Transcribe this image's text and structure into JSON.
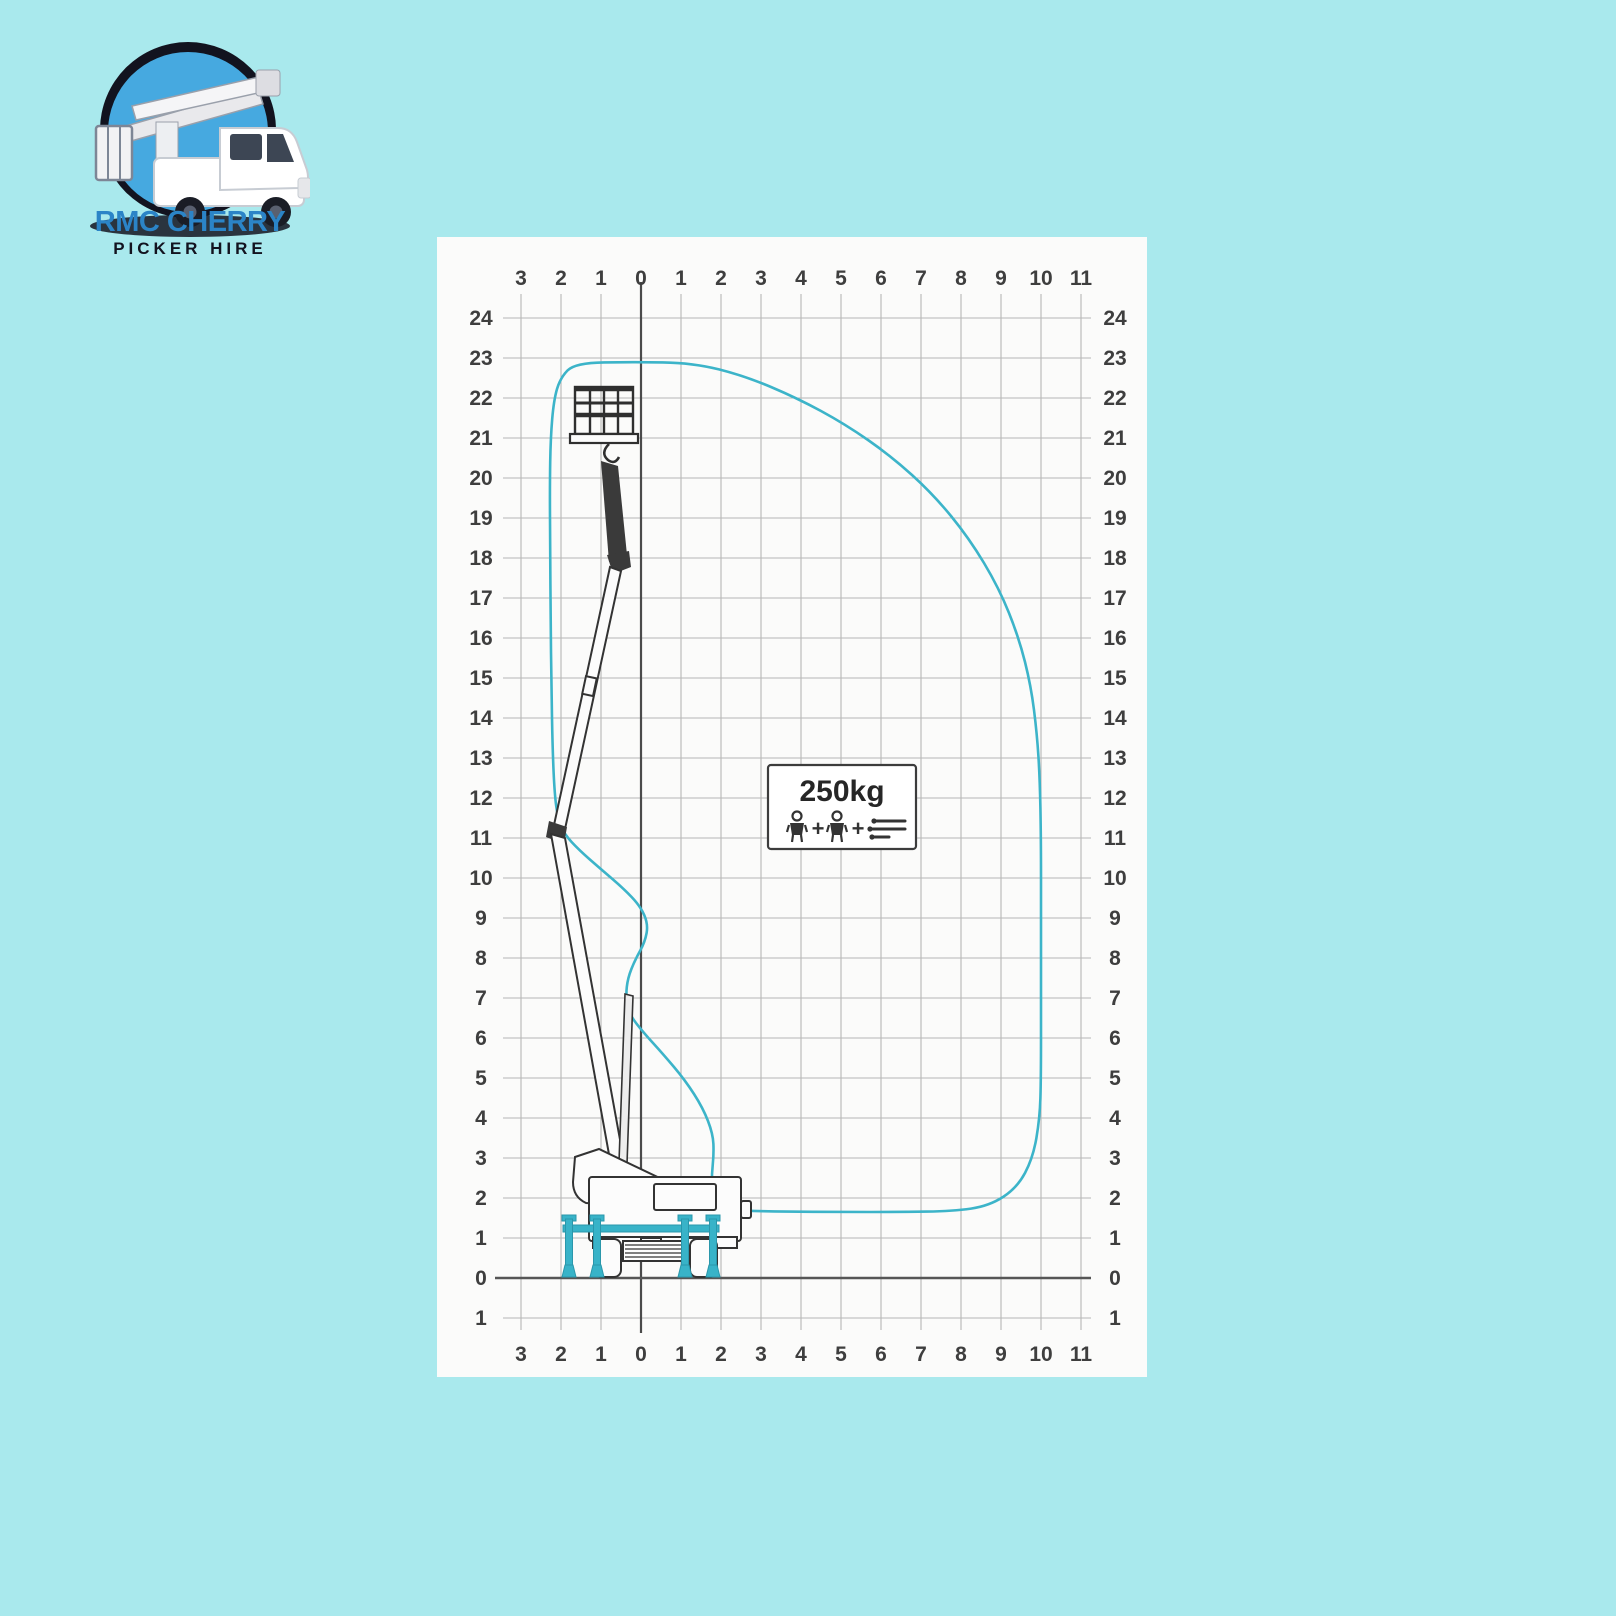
{
  "logo": {
    "title": "RMC CHERRY",
    "subtitle": "PICKER HIRE"
  },
  "colors": {
    "background": "#a9e9ed",
    "panel": "#fbfbfa",
    "envelope_line": "#3cb4c9",
    "outrigger_teal": "#38b3c8",
    "grid_line": "#b6b6b6",
    "axis_line": "#4a4a4a",
    "axis_label_text": "#3e3e3e",
    "logo_blue": "#2b84c7",
    "logo_dark": "#12131f",
    "logo_circle_fill": "#46a9e0"
  },
  "capacity": {
    "label": "250kg",
    "plus1": "+",
    "plus2": "+",
    "icons": [
      "person-icon",
      "person-icon",
      "tools-icon"
    ]
  },
  "chart_data": {
    "type": "area",
    "title": "Working envelope reach diagram (truck mounted cherry picker)",
    "xlabel": "outreach (m)",
    "ylabel": "working height (m)",
    "xlim": [
      -3,
      11
    ],
    "ylim": [
      -1,
      24
    ],
    "grid": true,
    "x_axis": {
      "units": [
        -3,
        -2,
        -1,
        0,
        1,
        2,
        3,
        4,
        5,
        6,
        7,
        8,
        9,
        10,
        11
      ],
      "labels": [
        "3",
        "2",
        "1",
        "0",
        "1",
        "2",
        "3",
        "4",
        "5",
        "6",
        "7",
        "8",
        "9",
        "10",
        "11"
      ]
    },
    "y_axis": {
      "units": [
        24,
        23,
        22,
        21,
        20,
        19,
        18,
        17,
        16,
        15,
        14,
        13,
        12,
        11,
        10,
        9,
        8,
        7,
        6,
        5,
        4,
        3,
        2,
        1,
        0,
        -1
      ],
      "labels": [
        "24",
        "23",
        "22",
        "21",
        "20",
        "19",
        "18",
        "17",
        "16",
        "15",
        "14",
        "13",
        "12",
        "11",
        "10",
        "9",
        "8",
        "7",
        "6",
        "5",
        "4",
        "3",
        "2",
        "1",
        "0",
        "1"
      ]
    },
    "envelope": {
      "max_height": 22.9,
      "max_outreach": 10.0,
      "points": [
        [
          -1.65,
          22.88
        ],
        [
          -0.2,
          22.9
        ],
        [
          1.3,
          22.88
        ],
        [
          2.6,
          22.55
        ],
        [
          3.9,
          22.0
        ],
        [
          5.1,
          21.35
        ],
        [
          6.25,
          20.55
        ],
        [
          7.3,
          19.6
        ],
        [
          8.2,
          18.5
        ],
        [
          8.95,
          17.25
        ],
        [
          9.45,
          16.0
        ],
        [
          9.75,
          14.8
        ],
        [
          9.9,
          13.6
        ],
        [
          9.97,
          12.5
        ],
        [
          10.0,
          11.0
        ],
        [
          10.0,
          9.0
        ],
        [
          10.0,
          7.0
        ],
        [
          10.0,
          5.0
        ],
        [
          9.97,
          4.0
        ],
        [
          9.8,
          3.0
        ],
        [
          9.4,
          2.25
        ],
        [
          8.7,
          1.8
        ],
        [
          7.8,
          1.67
        ],
        [
          6.5,
          1.65
        ],
        [
          5.0,
          1.65
        ],
        [
          3.6,
          1.66
        ],
        [
          2.5,
          1.68
        ],
        [
          1.98,
          1.78
        ],
        [
          1.77,
          2.1
        ],
        [
          1.77,
          2.6
        ],
        [
          1.82,
          3.1
        ],
        [
          1.8,
          3.6
        ],
        [
          1.55,
          4.25
        ],
        [
          1.1,
          4.95
        ],
        [
          0.55,
          5.6
        ],
        [
          0.05,
          6.15
        ],
        [
          -0.3,
          6.6
        ],
        [
          -0.38,
          7.05
        ],
        [
          -0.33,
          7.5
        ],
        [
          -0.15,
          7.95
        ],
        [
          0.1,
          8.4
        ],
        [
          0.18,
          8.85
        ],
        [
          -0.02,
          9.3
        ],
        [
          -0.45,
          9.75
        ],
        [
          -1.0,
          10.22
        ],
        [
          -1.55,
          10.7
        ],
        [
          -1.92,
          11.1
        ],
        [
          -2.08,
          11.5
        ],
        [
          -2.16,
          12.1
        ],
        [
          -2.21,
          13.2
        ],
        [
          -2.24,
          14.8
        ],
        [
          -2.26,
          16.5
        ],
        [
          -2.27,
          18.2
        ],
        [
          -2.28,
          19.8
        ],
        [
          -2.26,
          21.0
        ],
        [
          -2.18,
          21.95
        ],
        [
          -2.02,
          22.5
        ]
      ]
    }
  }
}
